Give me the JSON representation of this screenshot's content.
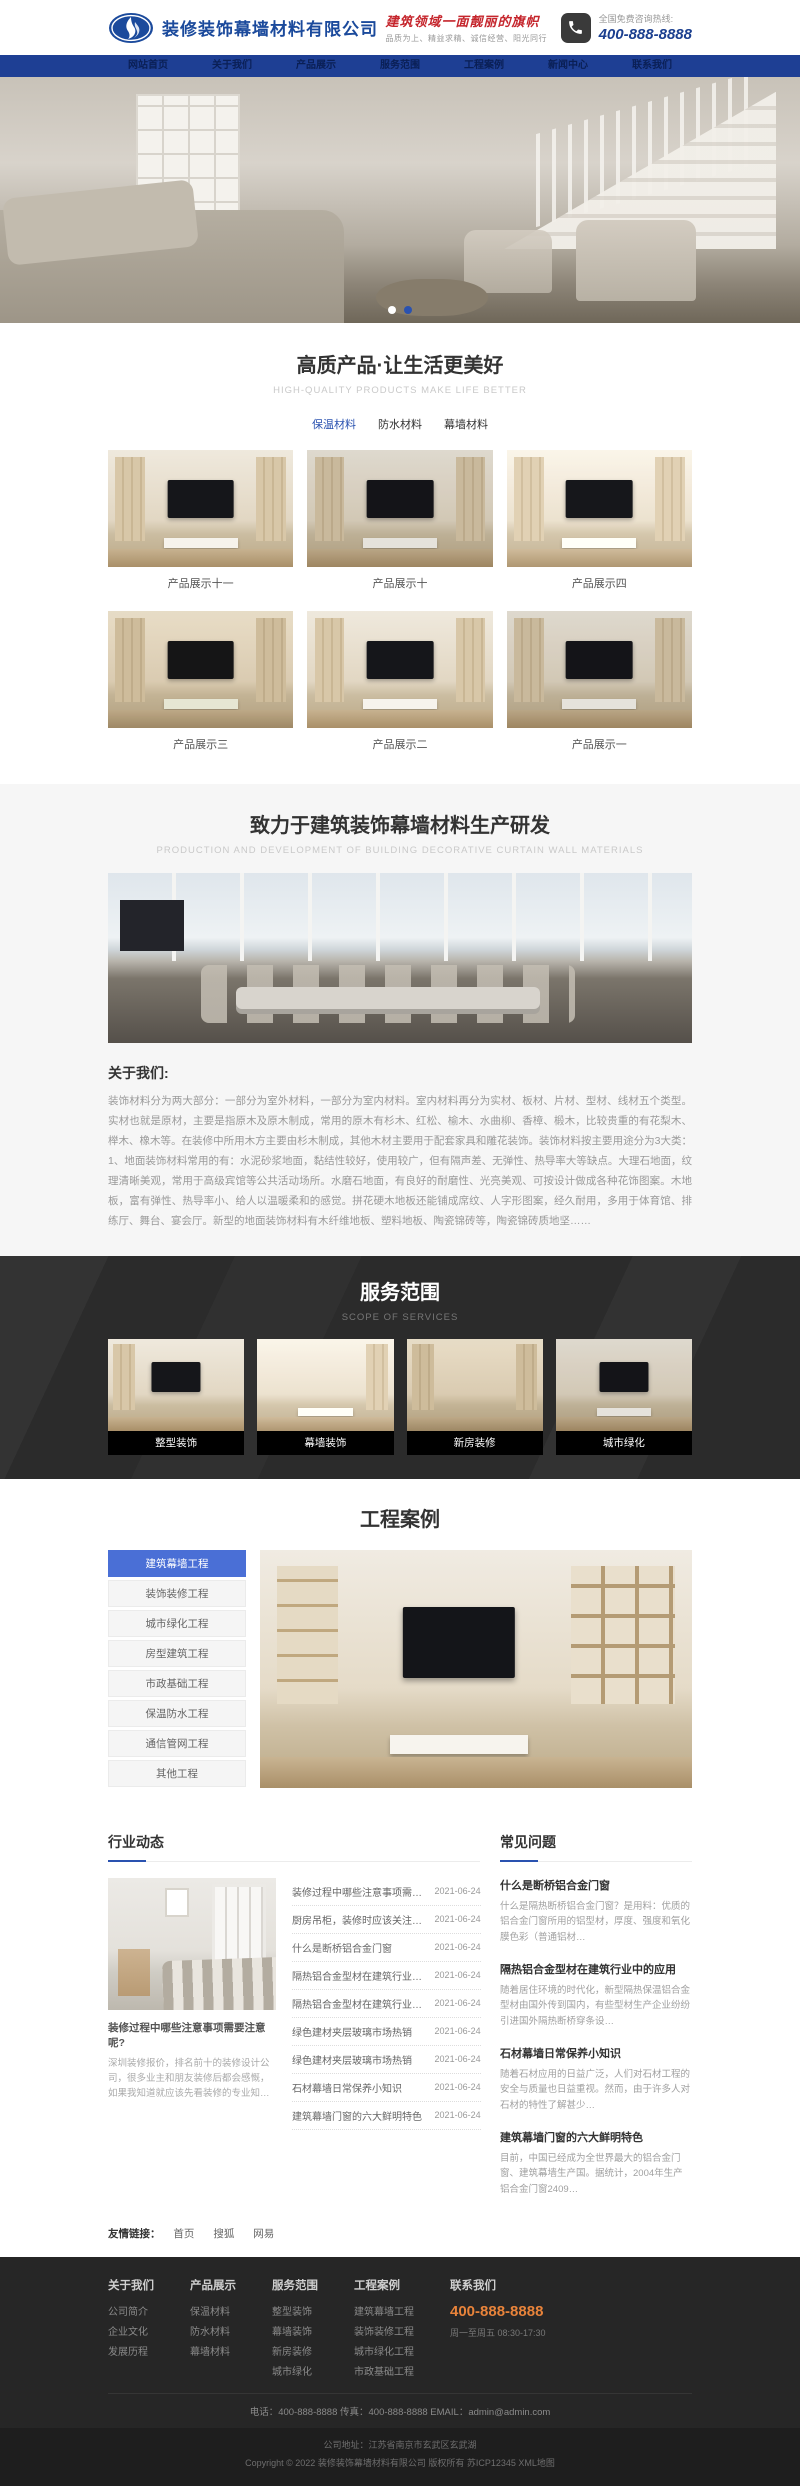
{
  "colors": {
    "accent_blue": "#2a52b0",
    "nav_blue": "#1e3f94",
    "slogan_red": "#c5252c",
    "phone_orange": "#e8833a",
    "active_menu_blue": "#4a6fd6"
  },
  "brand": {
    "company_name": "装修装饰幕墙材料有限公司",
    "slogan": "建筑领域一面靓丽的旗帜",
    "slogan_sub": "品质为上、精益求精、诚信经营、阳光同行",
    "hotline_label": "全国免费咨询热线:",
    "hotline_number": "400-888-8888"
  },
  "nav": {
    "items": [
      "网站首页",
      "关于我们",
      "产品展示",
      "服务范围",
      "工程案例",
      "新闻中心",
      "联系我们"
    ]
  },
  "products": {
    "title": "高质产品·让生活更美好",
    "subtitle": "HIGH-QUALITY PRODUCTS MAKE LIFE BETTER",
    "tabs": [
      "保温材料",
      "防水材料",
      "幕墙材料"
    ],
    "items": [
      "产品展示十一",
      "产品展示十",
      "产品展示四",
      "产品展示三",
      "产品展示二",
      "产品展示一"
    ]
  },
  "rd": {
    "title": "致力于建筑装饰幕墙材料生产研发",
    "subtitle": "Production and development of building decorative curtain wall materials",
    "about_heading": "关于我们:",
    "about_text": "装饰材料分为两大部分：一部分为室外材料，一部分为室内材料。室内材料再分为实材、板材、片材、型材、线材五个类型。实材也就是原材，主要是指原木及原木制成，常用的原木有杉木、红松、榆木、水曲柳、香樟、椴木，比较贵重的有花梨木、榉木、橡木等。在装修中所用木方主要由杉木制成，其他木材主要用于配套家具和雕花装饰。装饰材料按主要用途分为3大类：1、地面装饰材料常用的有：水泥砂浆地面，黏结性较好，使用较广，但有隔声差、无弹性、热导率大等缺点。大理石地面，纹理清晰美观，常用于高级宾馆等公共活动场所。水磨石地面，有良好的耐磨性、光亮美观、可按设计做成各种花饰图案。木地板，富有弹性、热导率小、给人以温暖柔和的感觉。拼花硬木地板还能铺成席纹、人字形图案，经久耐用，多用于体育馆、排练厅、舞台、宴会厅。新型的地面装饰材料有木纤维地板、塑料地板、陶瓷锦砖等，陶瓷锦砖质地坚……"
  },
  "services": {
    "title": "服务范围",
    "subtitle": "SCOPE OF SERVICES",
    "items": [
      "整型装饰",
      "幕墙装饰",
      "新房装修",
      "城市绿化"
    ]
  },
  "cases": {
    "title": "工程案例",
    "menu": [
      "建筑幕墙工程",
      "装饰装修工程",
      "城市绿化工程",
      "房型建筑工程",
      "市政基础工程",
      "保温防水工程",
      "通信管网工程",
      "其他工程"
    ]
  },
  "news": {
    "heading": "行业动态",
    "featured": {
      "title": "装修过程中哪些注意事项需要注意呢?",
      "desc": "深圳装修报价，排名前十的装修设计公司，很多业主和朋友装修后都会感慨，如果我知道就应该先看装修的专业知…"
    },
    "list": [
      {
        "title": "装修过程中哪些注意事项需要注意呢?",
        "date": "2021-06-24"
      },
      {
        "title": "厨房吊柜，装修时应该关注哪些问题?",
        "date": "2021-06-24"
      },
      {
        "title": "什么是断桥铝合金门窗",
        "date": "2021-06-24"
      },
      {
        "title": "隔热铝合金型材在建筑行业中的应用",
        "date": "2021-06-24"
      },
      {
        "title": "隔热铝合金型材在建筑行业中的应用",
        "date": "2021-06-24"
      },
      {
        "title": "绿色建材夹层玻璃市场热销",
        "date": "2021-06-24"
      },
      {
        "title": "绿色建材夹层玻璃市场热销",
        "date": "2021-06-24"
      },
      {
        "title": "石材幕墙日常保养小知识",
        "date": "2021-06-24"
      },
      {
        "title": "建筑幕墙门窗的六大鲜明特色",
        "date": "2021-06-24"
      }
    ]
  },
  "faq": {
    "heading": "常见问题",
    "items": [
      {
        "title": "什么是断桥铝合金门窗",
        "desc": "什么是隔热断桥铝合金门窗？是用料：优质的铝合金门窗所用的铝型材，厚度、强度和氧化膜色彩（普通铝材…"
      },
      {
        "title": "隔热铝合金型材在建筑行业中的应用",
        "desc": "随着居住环境的时代化，新型隔热保温铝合金型材由国外传到国内，有些型材生产企业纷纷引进国外隔热断桥穿条设…"
      },
      {
        "title": "石材幕墙日常保养小知识",
        "desc": "随着石材应用的日益广泛，人们对石材工程的安全与质量也日益重视。然而，由于许多人对石材的特性了解甚少…"
      },
      {
        "title": "建筑幕墙门窗的六大鲜明特色",
        "desc": "目前，中国已经成为全世界最大的铝合金门窗、建筑幕墙生产国。据统计，2004年生产铝合金门窗2409…"
      }
    ]
  },
  "friend_links": {
    "label": "友情链接：",
    "links": [
      "首页",
      "搜狐",
      "网易"
    ]
  },
  "footer": {
    "columns": [
      {
        "title": "关于我们",
        "links": [
          "公司简介",
          "企业文化",
          "发展历程"
        ]
      },
      {
        "title": "产品展示",
        "links": [
          "保温材料",
          "防水材料",
          "幕墙材料"
        ]
      },
      {
        "title": "服务范围",
        "links": [
          "整型装饰",
          "幕墙装饰",
          "新房装修",
          "城市绿化"
        ]
      },
      {
        "title": "工程案例",
        "links": [
          "建筑幕墙工程",
          "装饰装修工程",
          "城市绿化工程",
          "市政基础工程"
        ]
      }
    ],
    "contact_title": "联系我们",
    "phone": "400-888-8888",
    "hours": "周一至周五 08:30-17:30",
    "info_line": "电话：400-888-8888      传真：400-888-8888      EMAIL：admin@admin.com",
    "address_line": "公司地址：江苏省南京市玄武区玄武湖",
    "copyright_line": "Copyright © 2022 装修装饰幕墙材料有限公司 版权所有 苏ICP12345 XML地图"
  }
}
